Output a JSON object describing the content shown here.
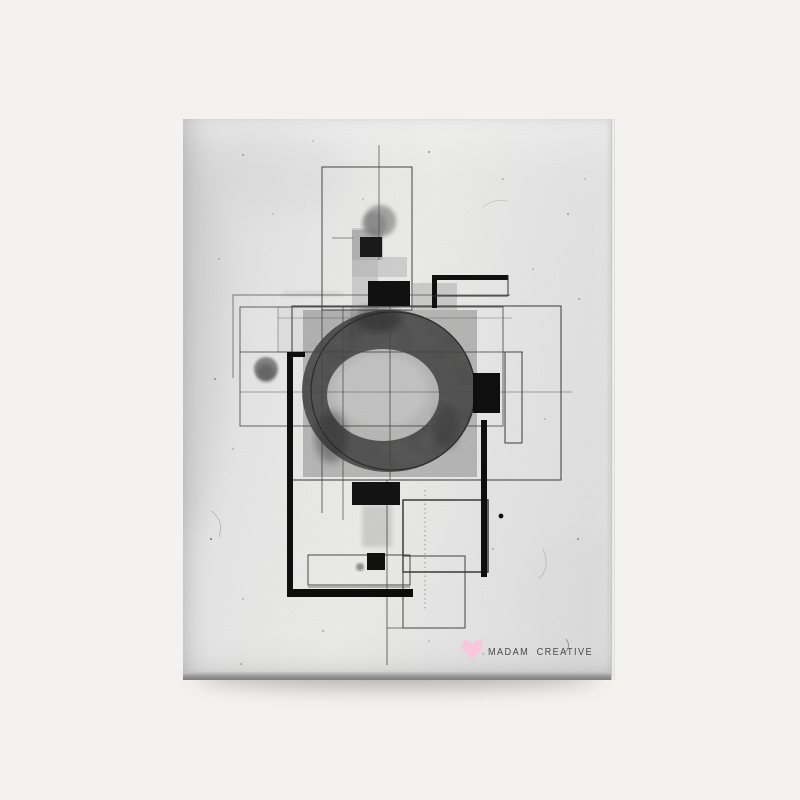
{
  "scene": {
    "background_color": "#f4f2ee"
  },
  "canvas": {
    "surface_color": "#e9e9e9",
    "side_shade_color": "#8f8f8f",
    "edge_highlight_color": "#f4f4f4"
  },
  "artwork": {
    "ink_black": "#111111",
    "wash_gray": "#969696",
    "line_gray": "#4a4a4a",
    "ring_gray": "#424242"
  },
  "branding": {
    "label": "MADAM CREATIVE",
    "text_color": "#4a4a4a",
    "heart_color": "#f9c6dc"
  }
}
